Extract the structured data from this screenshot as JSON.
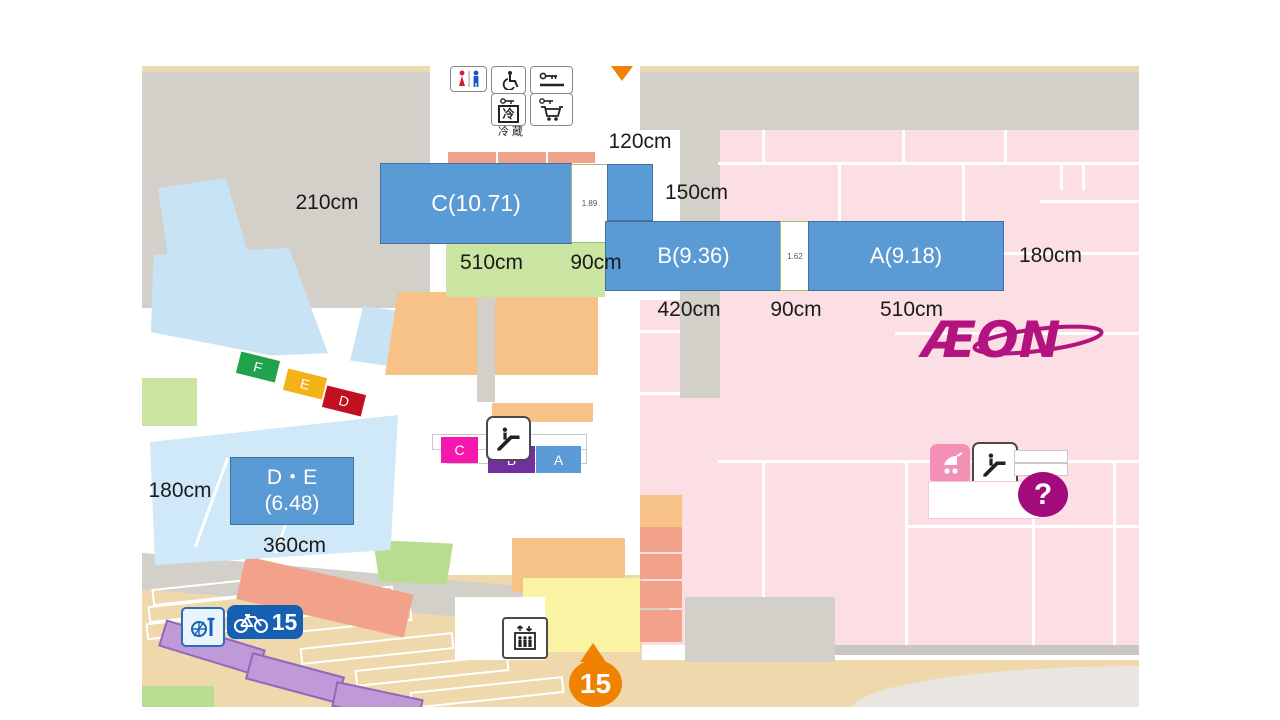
{
  "map": {
    "blocks": [
      {
        "id": "C",
        "label": "C(10.71)"
      },
      {
        "id": "B",
        "label": "B(9.36)"
      },
      {
        "id": "A",
        "label": "A(9.18)"
      },
      {
        "id": "DE",
        "line1": "D・E",
        "line2": "(6.48)"
      }
    ],
    "gap_values": [
      "1.89",
      "1.62"
    ],
    "measurements": [
      "120cm",
      "210cm",
      "150cm",
      "510cm",
      "90cm",
      "180cm",
      "420cm",
      "90cm",
      "510cm",
      "180cm",
      "360cm"
    ],
    "route_chips": [
      "F",
      "E",
      "D"
    ],
    "entrance_chips": [
      "C",
      "B",
      "A"
    ],
    "refrigerated_label": "冷蔵",
    "fridge_char": "冷",
    "bicycle_capacity": "15",
    "entrance_number": "15",
    "question_mark": "?",
    "logo_text": "ÆON",
    "colors": {
      "annotation_blue": "#5b9bd5",
      "store_pink": "#fcdfe4",
      "tenant_orange": "#f6c287",
      "salmon": "#f2a18b",
      "road_gray": "#d3cfc9",
      "parking_blue": "#c8e4f4",
      "green": "#cae4a2",
      "tan": "#eed8ac",
      "stall_purple": "#bf99d8",
      "entrance_orange": "#ef8200",
      "aeon_magenta": "#b3137e",
      "chip_f_green": "#21a24c",
      "chip_e_amber": "#f3b217",
      "chip_d_red": "#c01022",
      "chip_c_magenta": "#f618ae",
      "chip_b_purple": "#7030a0",
      "bike_blue": "#1660b4"
    }
  }
}
